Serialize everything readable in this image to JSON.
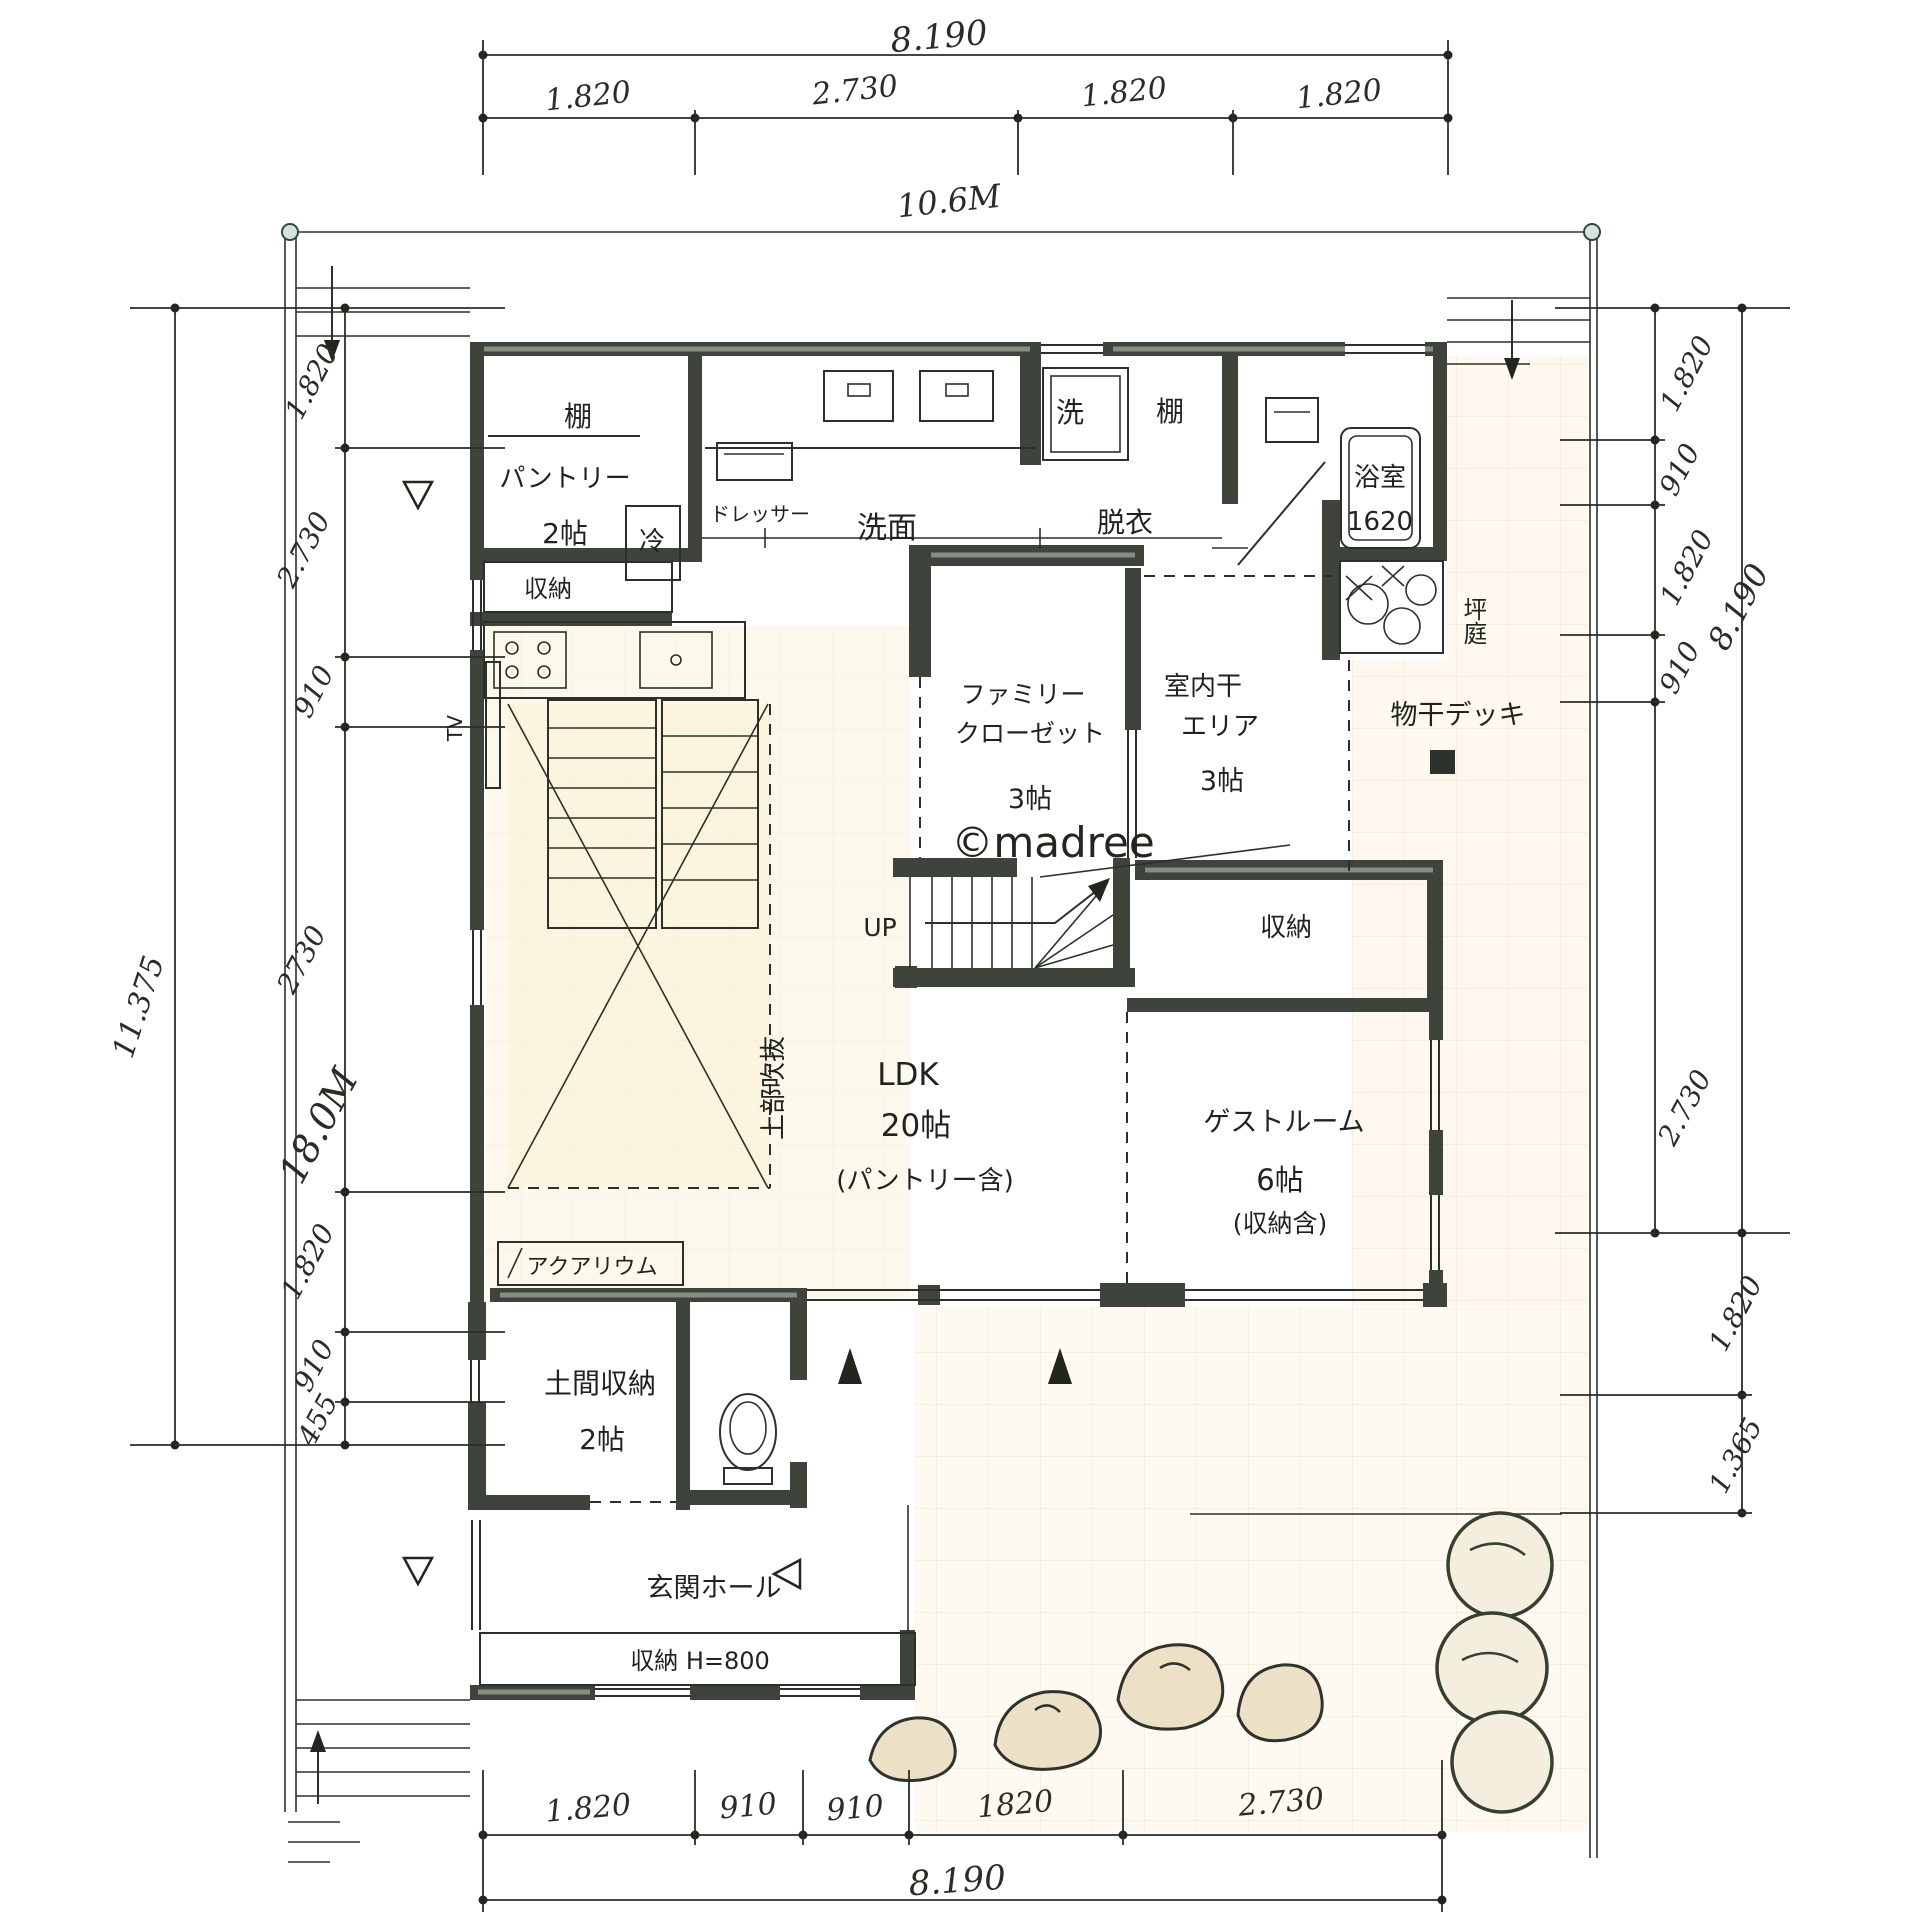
{
  "watermark": "©madree",
  "site": {
    "width_label": "10.6M",
    "depth_label": "18.0M"
  },
  "dims": {
    "top_total": "8.190",
    "top_segments": [
      "1.820",
      "2.730",
      "1.820",
      "1.820"
    ],
    "bottom_segments": [
      "1.820",
      "910",
      "910",
      "1820",
      "2.730"
    ],
    "bottom_total": "8.190",
    "left_total": "11.375",
    "left_segments": [
      "1.820",
      "2.730",
      "910",
      "2730",
      "1.820",
      "910",
      "455"
    ],
    "right_segments": [
      "1.820",
      "910",
      "1.820",
      "910",
      "2.730"
    ],
    "right_total": "8.190",
    "right_lower_segments": [
      "1.820",
      "1.365"
    ]
  },
  "rooms": {
    "shelf_pantry": "棚",
    "pantry_name": "パントリー",
    "pantry_size": "2帖",
    "fridge": "冷",
    "dresser": "ドレッサー",
    "washroom": "洗面",
    "washer": "洗",
    "shelf_right": "棚",
    "undressing": "脱衣",
    "bath_name": "浴室",
    "bath_size": "1620",
    "courtyard": "坪庭",
    "storage_pantry": "収納",
    "family_closet_line1": "ファミリー",
    "family_closet_line2": "クローゼット",
    "family_closet_size": "3帖",
    "indoor_drying_line1": "室内干",
    "indoor_drying_line2": "エリア",
    "indoor_drying_size": "3帖",
    "drying_deck": "物干デッキ",
    "stairs_up": "UP",
    "storage_stairs": "収納",
    "void_above": "上部吹抜",
    "tv": "TV",
    "ldk_name": "LDK",
    "ldk_size": "20帖",
    "ldk_note": "(パントリー含)",
    "guest_name": "ゲストルーム",
    "guest_size": "6帖",
    "guest_note": "(収納含)",
    "aquarium": "アクアリウム",
    "doma_name": "土間収納",
    "doma_size": "2帖",
    "entrance_hall": "玄関ホール",
    "entrance_storage": "収納 H=800"
  }
}
